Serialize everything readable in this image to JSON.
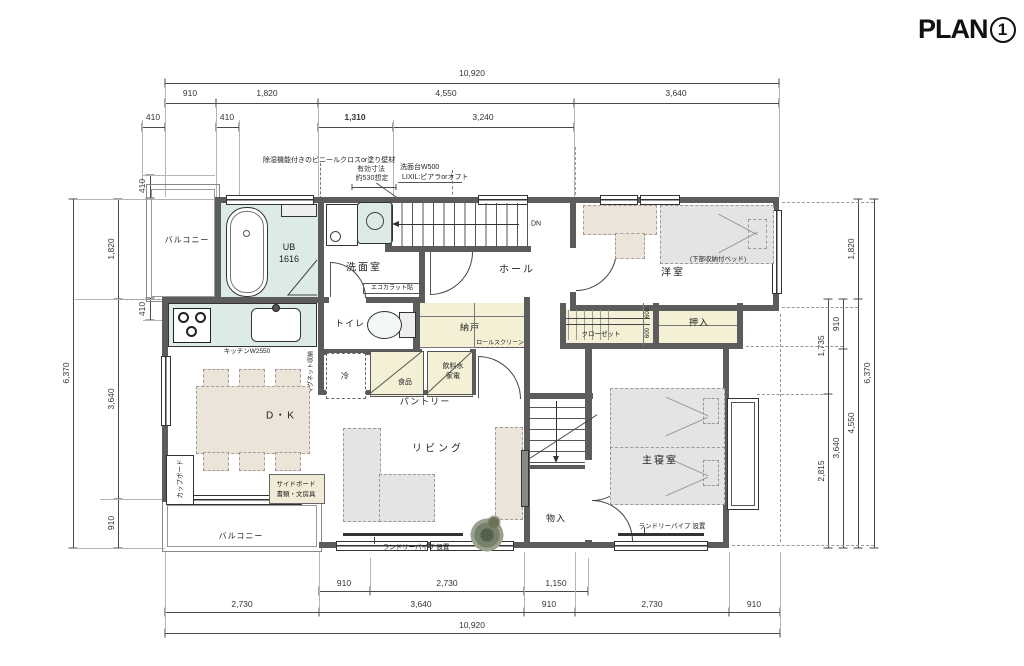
{
  "title": {
    "text": "PLAN",
    "number": "1"
  },
  "rooms": {
    "balcony_top": "バルコニー",
    "bath_line1": "UB",
    "bath_line2": "1616",
    "washroom": "洗面室",
    "hall": "ホール",
    "western_room": "洋室",
    "toilet": "トイレ",
    "storeroom": "納戸",
    "closet": "クローゼット",
    "oshiire": "押入",
    "fridge": "冷",
    "food": "食品",
    "drink_line1": "飲料水",
    "drink_line2": "家電",
    "pantry": "パントリー",
    "dining_kitchen": "D・K",
    "living": "リビング",
    "storage": "物入",
    "master_bedroom": "主寝室",
    "balcony_bottom": "バルコニー"
  },
  "annotations": {
    "wall_finish": "除湿機能付きのビニールクロスor塗り壁材",
    "effective_dim_line1": "有効寸法",
    "effective_dim_line2": "約530想定",
    "vanity_line1": "洗面台W500",
    "vanity_line2": "LIXIL:ピアラorオフト",
    "down": "DN",
    "bed_note": "(下部収納付ベッド)",
    "roll_screen": "ロールスクリーン",
    "closet_depth_a": "600",
    "closet_depth_b": "600",
    "kitchen_width": "キッチンW2550",
    "magnet": "マグネット収納",
    "ecocarat": "エコカラット貼",
    "laundry_living": "ランドリーパイプ 設置",
    "laundry_bedroom": "ランドリーパイプ 設置",
    "cupboard": "カップボード",
    "sideboard_line1": "サイドボード",
    "sideboard_line2": "書類・文房具"
  },
  "dimensions": {
    "top_total": "10,920",
    "top_row2": [
      "910",
      "1,820",
      "4,550",
      "3,640"
    ],
    "top_row3": [
      "410",
      "410",
      "1,310",
      "3,240"
    ],
    "bottom_row1": [
      "910",
      "2,730",
      "1,150"
    ],
    "bottom_row2": [
      "2,730",
      "3,640",
      "910",
      "2,730",
      "910"
    ],
    "bottom_total": "10,920",
    "left": [
      "410",
      "1,820",
      "410",
      "3,640",
      "910",
      "6,370"
    ],
    "right": [
      "1,820",
      "910",
      "1,735",
      "2,815",
      "3,640",
      "4,550",
      "6,370"
    ]
  }
}
